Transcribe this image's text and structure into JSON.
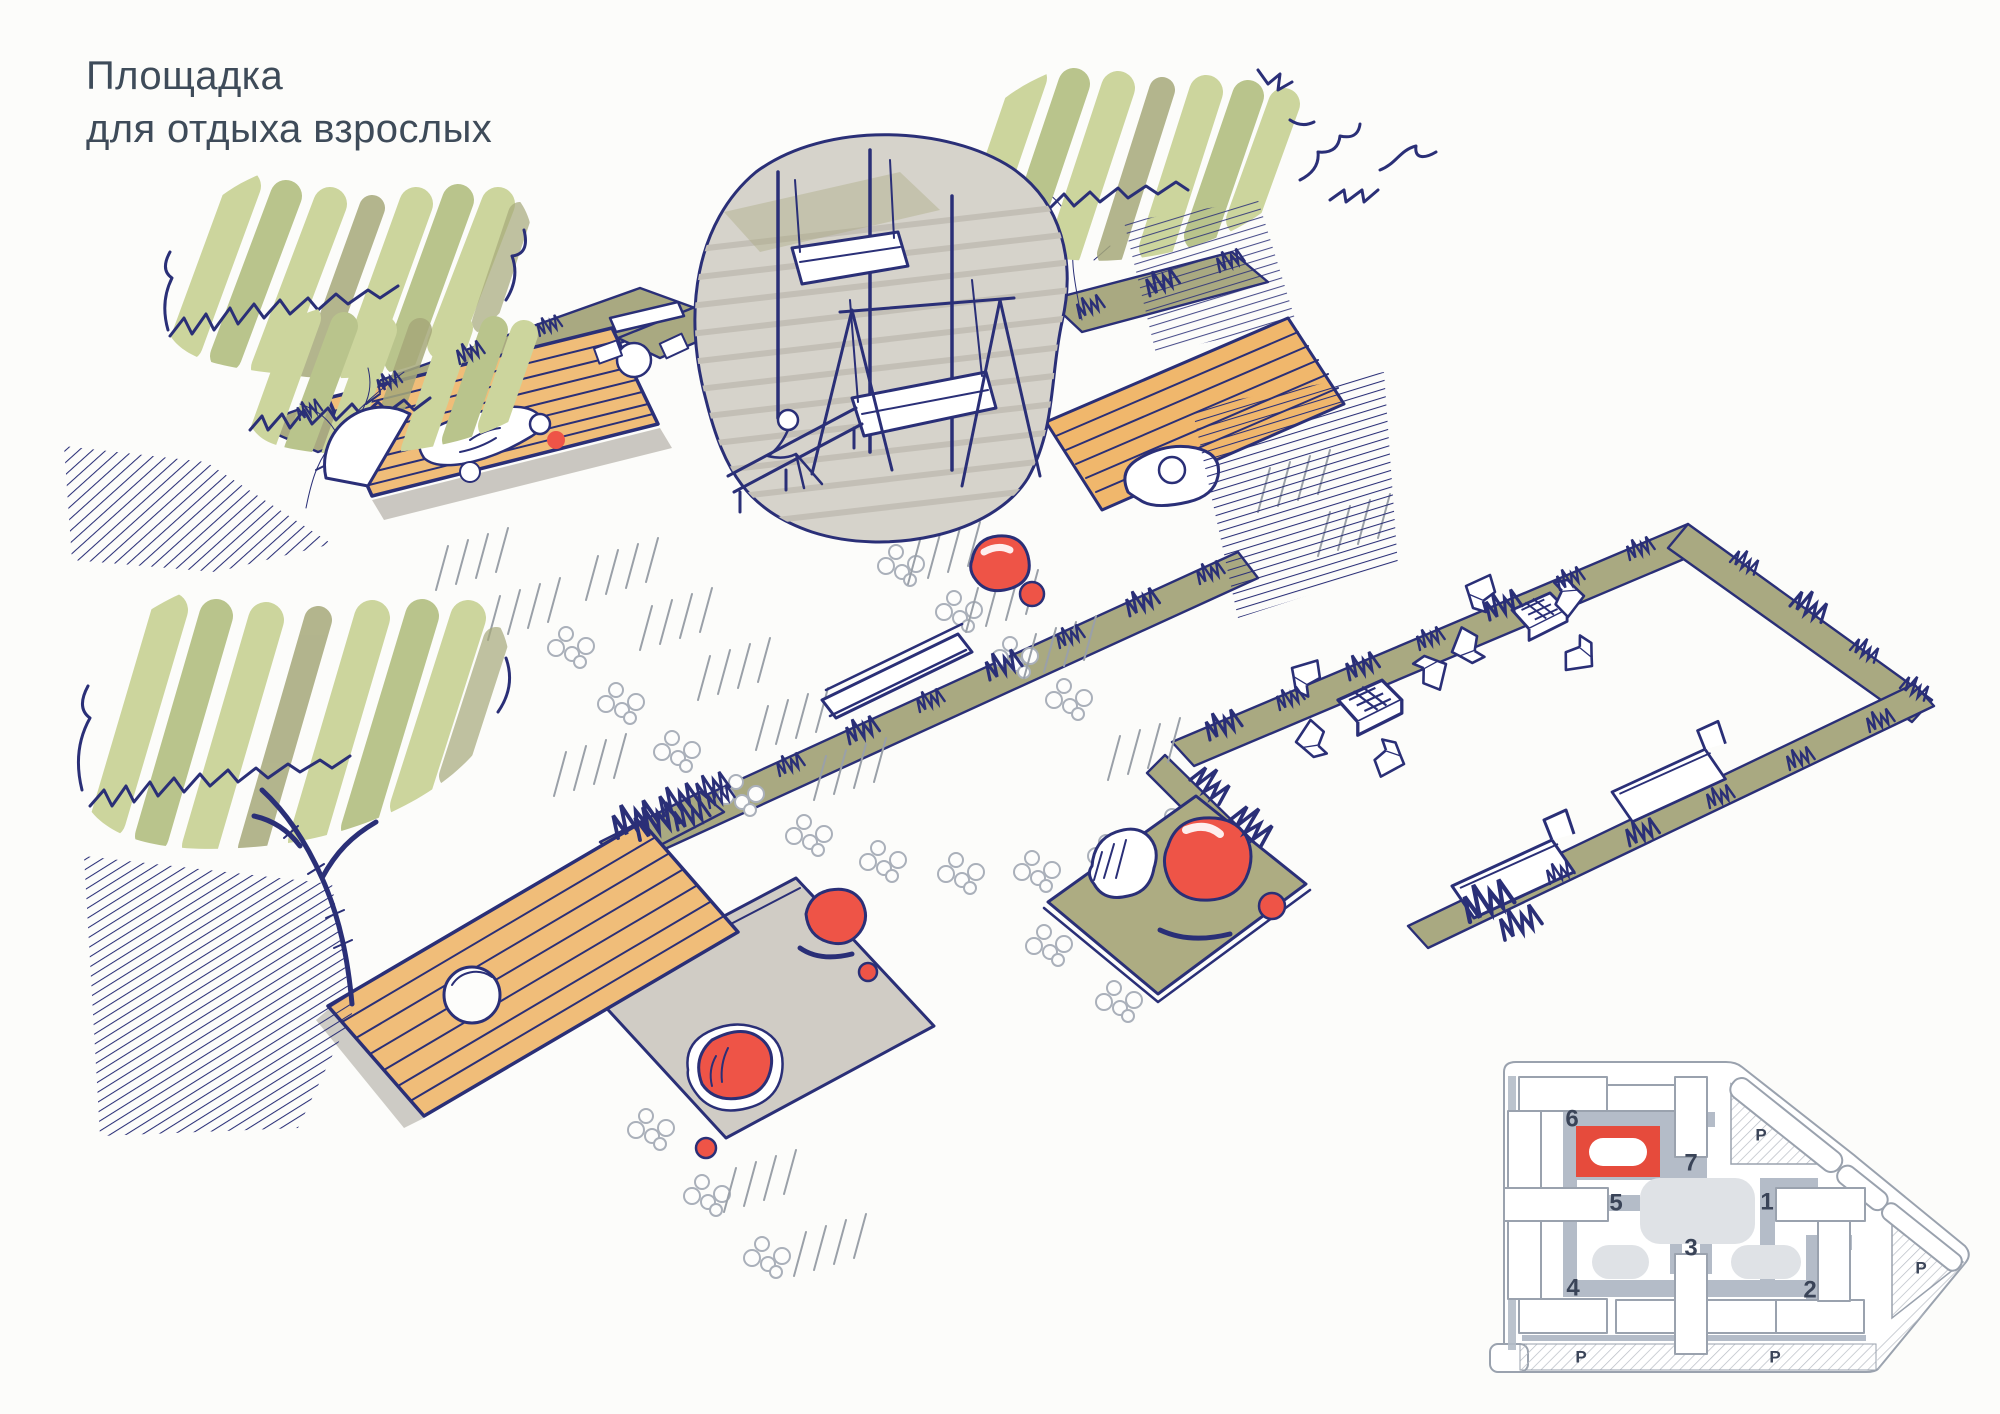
{
  "title": {
    "line1": "Площадка",
    "line2": "для отдыха взрослых"
  },
  "palette": {
    "ink": "#2a2f77",
    "foliage_light": "#ccd59d",
    "foliage_mid": "#b9c48c",
    "foliage_olive": "#a6a87a",
    "ground_olive": "#a9a981",
    "wood": "#f0bd79",
    "canopy_gray": "#d6d3cb",
    "paving_gray": "#d0ccc5",
    "accent_red": "#ee5447",
    "pebble_gray": "#aab0ba",
    "title_color": "#3e4b59"
  },
  "minimap": {
    "highlight_color": "#e64b3c",
    "path_color": "#b4bcc8",
    "highlighted_site": "6",
    "sites": [
      {
        "label": "1"
      },
      {
        "label": "2"
      },
      {
        "label": "3"
      },
      {
        "label": "4"
      },
      {
        "label": "5"
      },
      {
        "label": "6"
      },
      {
        "label": "7"
      }
    ],
    "parking": [
      {
        "label": "P"
      },
      {
        "label": "P"
      },
      {
        "label": "P"
      },
      {
        "label": "P"
      }
    ]
  }
}
